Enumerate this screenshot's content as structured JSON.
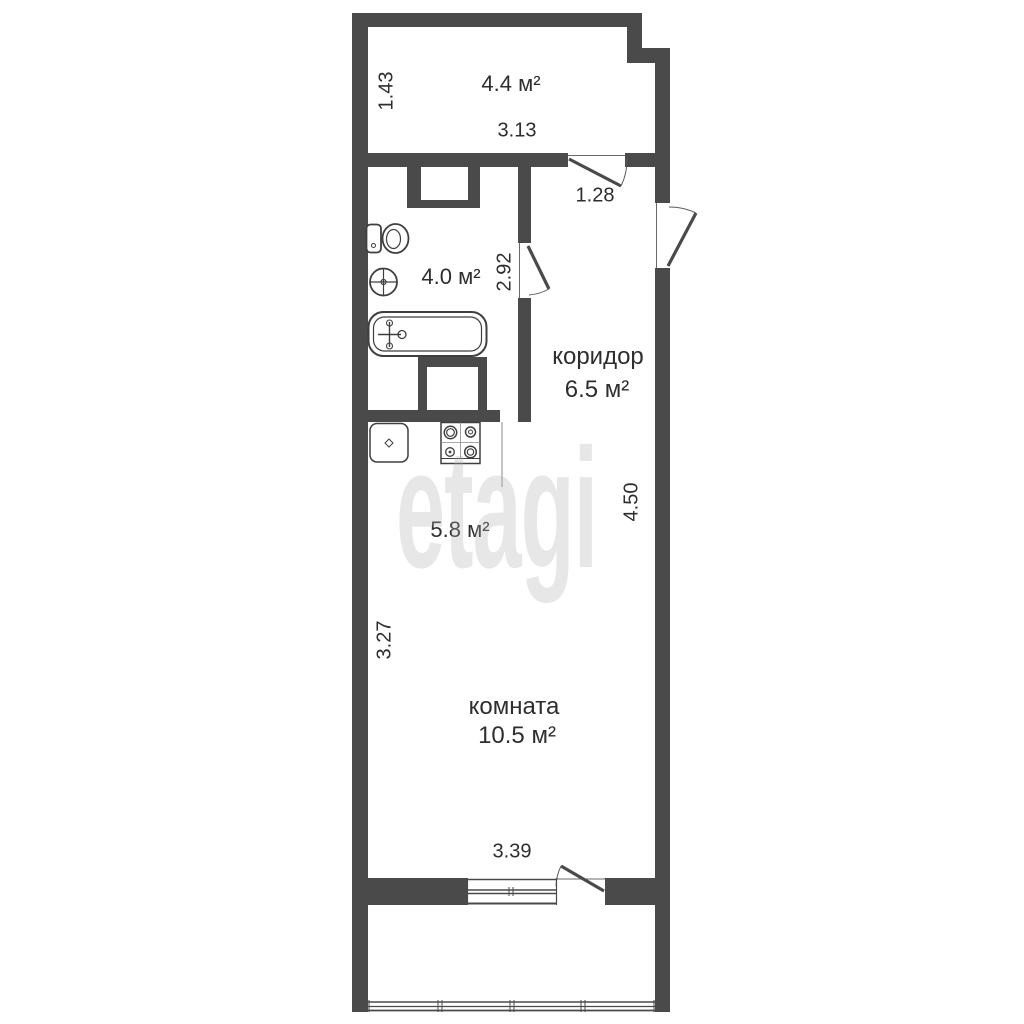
{
  "watermark": {
    "text": "etagi"
  },
  "colors": {
    "wall": "#4a4a4a",
    "text": "#2e2e2e",
    "watermark": "#e7e7e7",
    "background": "#ffffff"
  },
  "rooms": {
    "balcony_top": {
      "area": "4.4 м²"
    },
    "bathroom": {
      "area": "4.0 м²"
    },
    "corridor": {
      "name": "коридор",
      "area": "6.5 м²"
    },
    "kitchen": {
      "area": "5.8 м²"
    },
    "living_room": {
      "name": "комната",
      "area": "10.5 м²"
    }
  },
  "dimensions": {
    "balcony_top_depth": "1.43",
    "balcony_top_width": "3.13",
    "balcony_door_width": "1.28",
    "bathroom_height": "2.92",
    "corridor_length": "4.50",
    "kitchen_room_height": "3.27",
    "room_width": "3.39"
  },
  "fixtures": [
    "toilet",
    "wash-basin",
    "bathtub",
    "kitchen-sink",
    "stove"
  ]
}
